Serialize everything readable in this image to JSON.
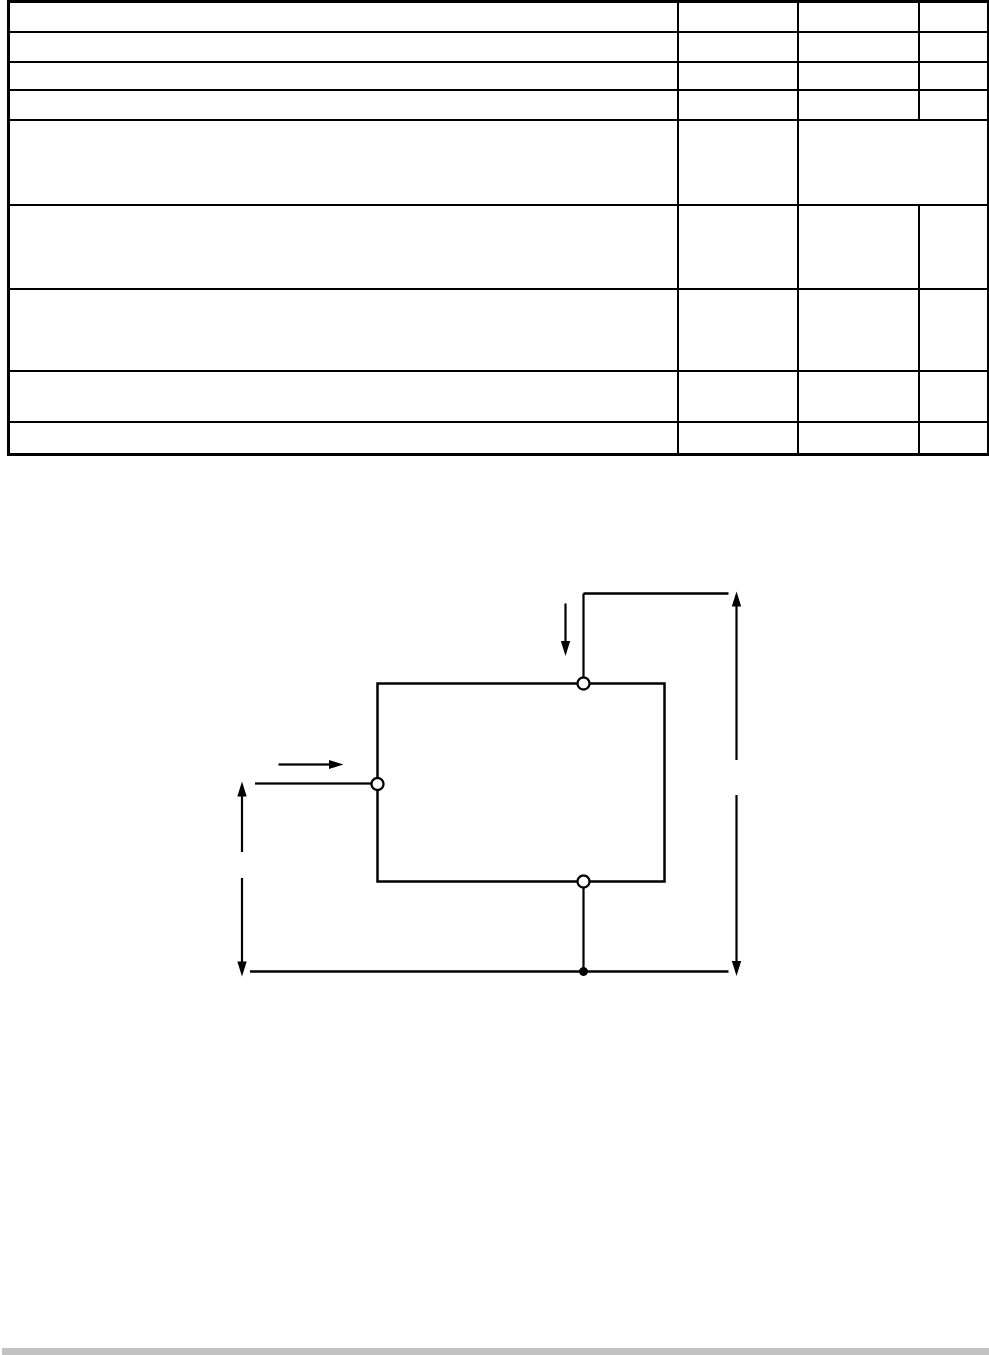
{
  "page": {
    "background_color": "#ffffff",
    "line_color": "#000000"
  },
  "table": {
    "line_color": "#000000",
    "column_widths_px": [
      669,
      120,
      121,
      70
    ],
    "rows": [
      {
        "cells": [
          "",
          "",
          "",
          ""
        ]
      },
      {
        "cells": [
          "",
          "",
          "",
          ""
        ]
      },
      {
        "cells": [
          "",
          "",
          "",
          ""
        ]
      },
      {
        "cells": [
          "",
          "",
          "",
          ""
        ]
      },
      {
        "cells": [
          "",
          "",
          ""
        ]
      },
      {
        "cells": [
          "",
          "",
          "",
          ""
        ]
      },
      {
        "cells": [
          "",
          "",
          "",
          ""
        ]
      },
      {
        "cells": [
          "",
          "",
          "",
          ""
        ]
      },
      {
        "cells": [
          "",
          "",
          "",
          ""
        ]
      }
    ]
  },
  "diagram": {
    "line_color": "#000000",
    "parts": [
      "device-under-test-box",
      "top-terminal",
      "left-terminal",
      "bottom-terminal",
      "top-supply-line",
      "current-down-arrow",
      "input-right-arrow",
      "right-voltage-dimension-arrow",
      "left-voltage-dimension-arrow",
      "bottom-common-rail",
      "junction-dot"
    ]
  },
  "scrollbar": {
    "track_color": "#c2c2c2"
  }
}
